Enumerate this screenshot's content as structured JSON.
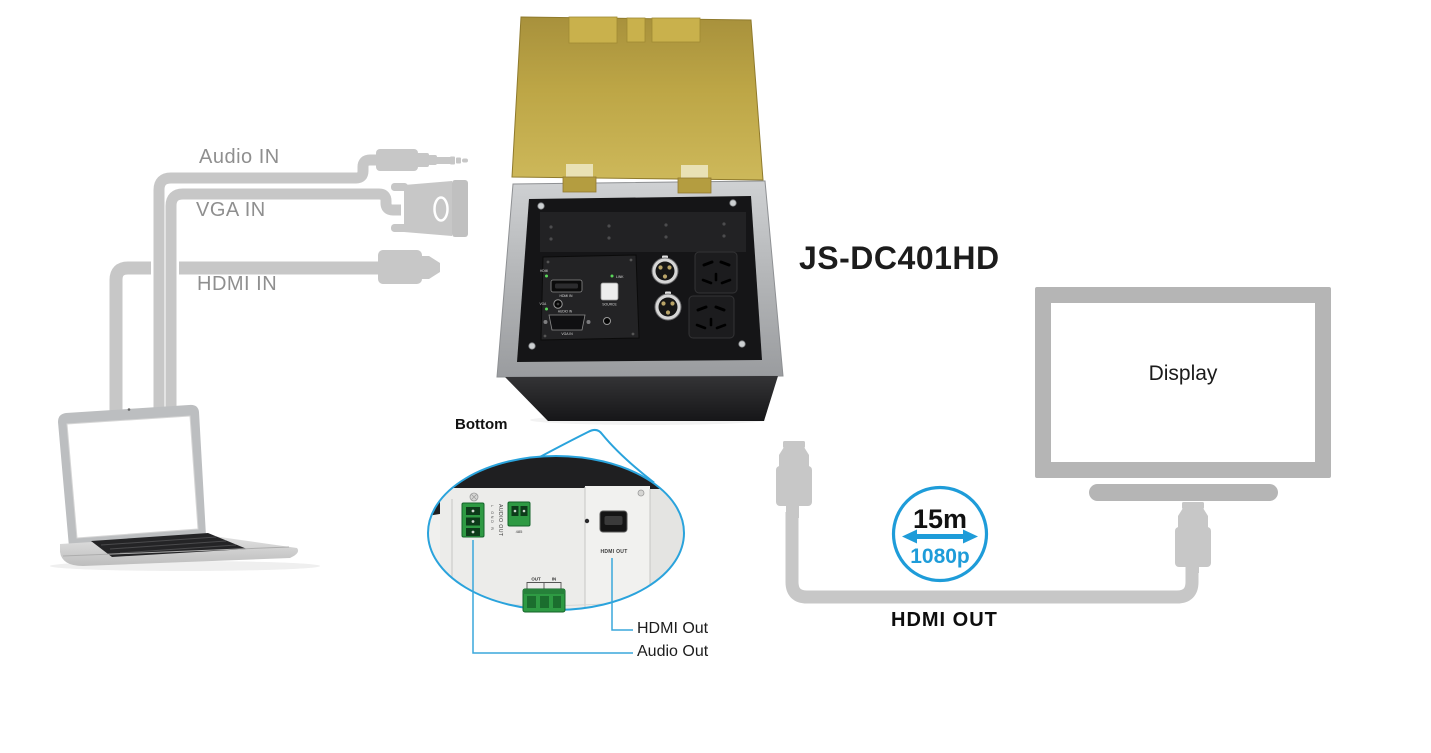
{
  "product": {
    "model": "JS-DC401HD",
    "panel_labels": {
      "hdmi_led": "HDMI",
      "hdmi_port": "HDMI IN",
      "link_led": "LINK",
      "source_button": "SOURCE",
      "vga_led": "VGA",
      "audio_port": "AUDIO IN",
      "vga_port": "VGA IN"
    }
  },
  "input_cables": {
    "audio": "Audio IN",
    "vga": "VGA IN",
    "hdmi": "HDMI IN"
  },
  "bottom_view": {
    "title": "Bottom",
    "audio_terminal_label": "AUDIO OUT",
    "audio_terminal_pins": "L GND R",
    "serial_label": "485",
    "hdmi_port_label": "HDMI OUT",
    "loop_out": "OUT",
    "loop_in": "IN",
    "callout_hdmi": "HDMI Out",
    "callout_audio": "Audio Out"
  },
  "output_link": {
    "badge_distance": "15m",
    "badge_resolution": "1080p",
    "cable_label": "HDMI OUT",
    "display_label": "Display"
  },
  "colors": {
    "accent_blue": "#1e9cd9",
    "callout_blue": "#3aa7db",
    "cable_gray": "#c7c7c7",
    "label_gray": "#8f8f8f",
    "brass": "#c0a843",
    "frame_silver": "#b0b2b4",
    "box_black": "#232325",
    "terminal_green": "#2e9a43"
  }
}
